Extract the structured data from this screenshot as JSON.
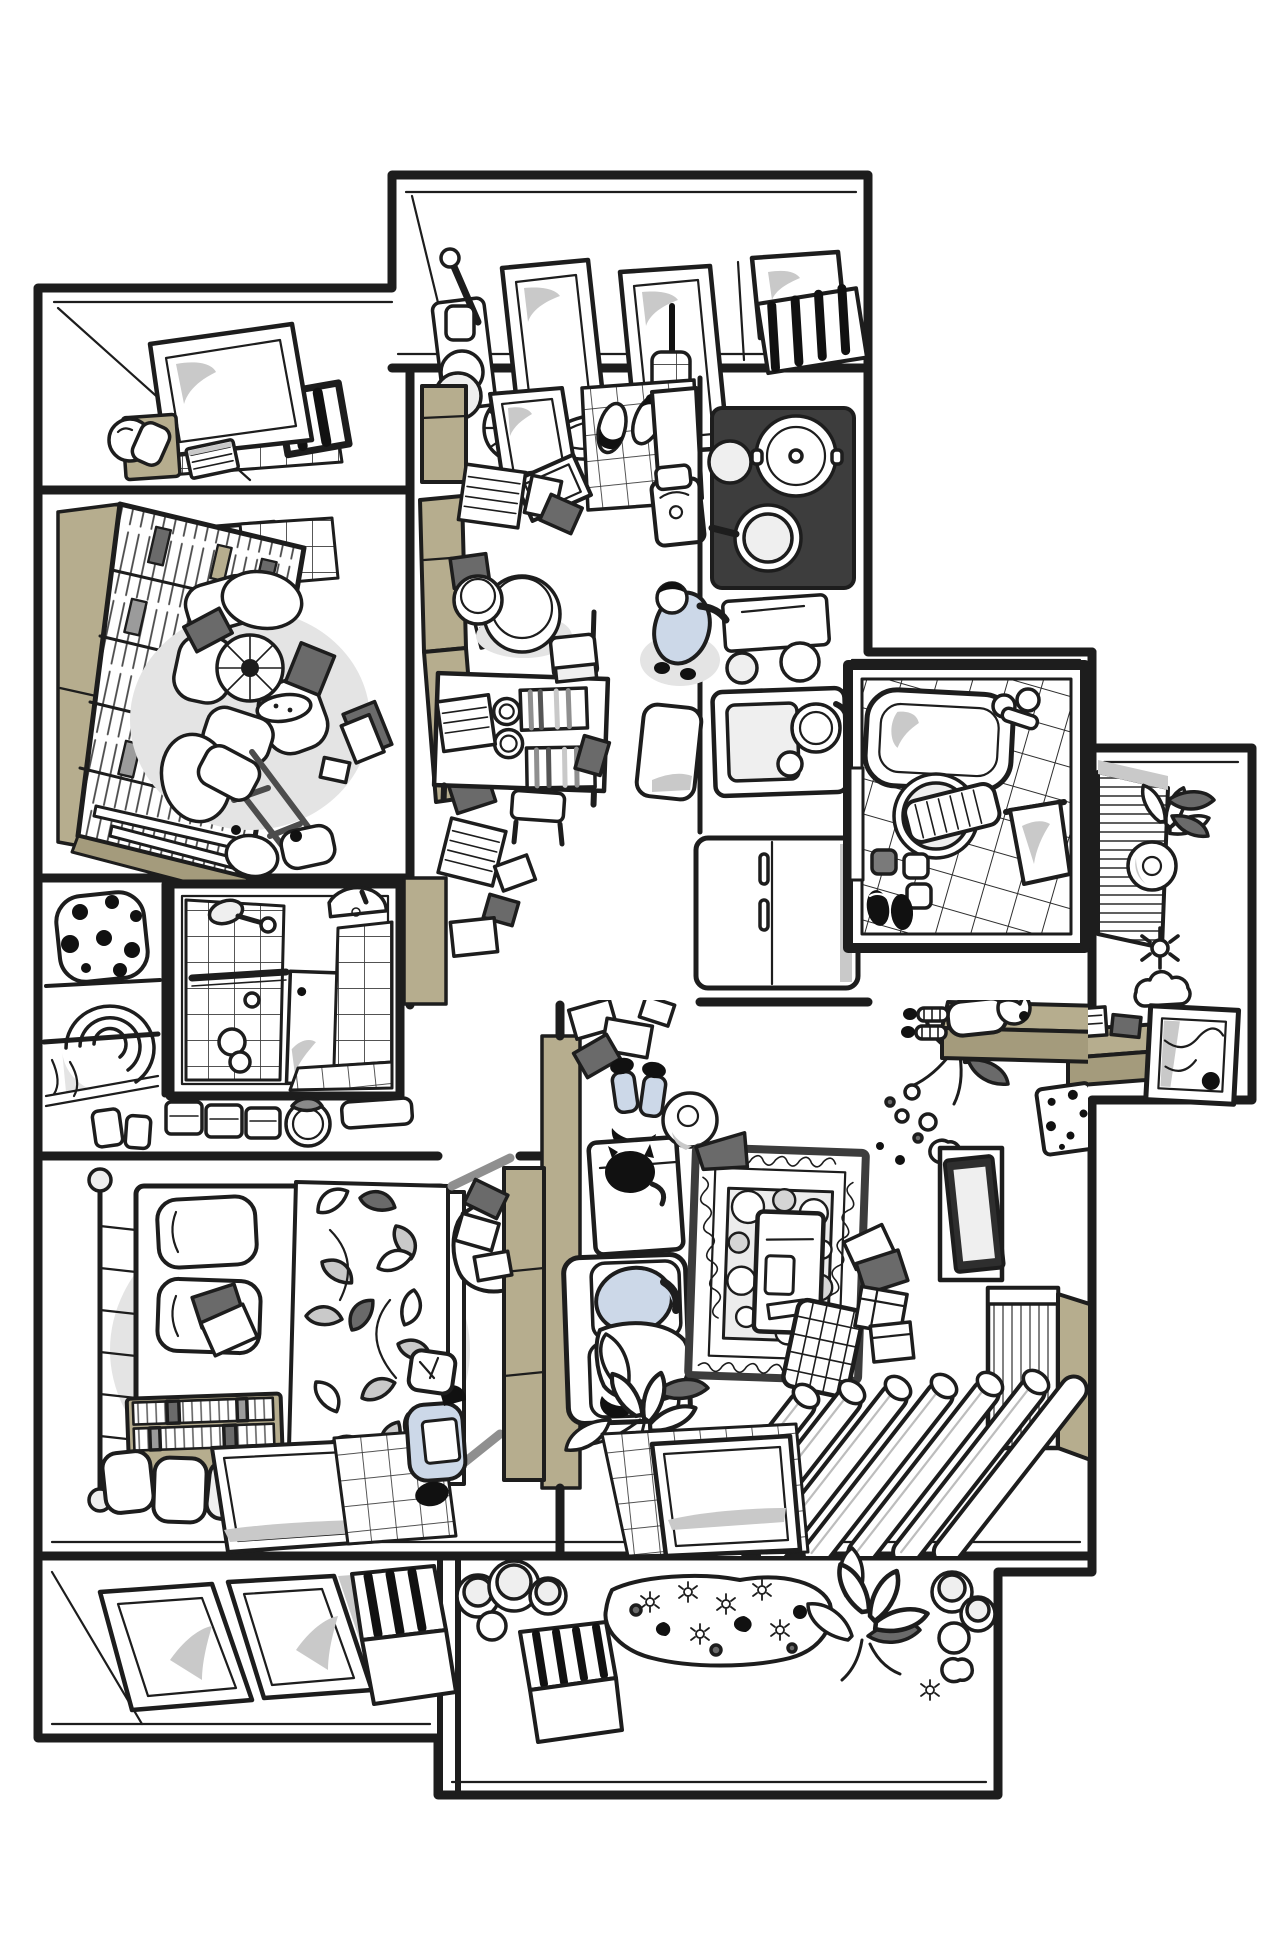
{
  "illustration": {
    "title": "Top-down cutaway illustration of a cluttered apartment floor plan",
    "medium": "hand-drawn black line art with tan, grey and pale-blue accents",
    "palette": {
      "ink": "#1d1d1d",
      "black": "#111111",
      "wall_white": "#ffffff",
      "tan": "#b6ad8e",
      "tan_dark": "#a49b7c",
      "object_dark": "#6a6a6a",
      "glass_grey": "#c9c9c9",
      "shadow_grey": "#e4e4e4",
      "clothing_blue": "#ccd8e8"
    },
    "rooms": [
      {
        "id": "utility-balcony",
        "label": "utility balcony (top)",
        "objects": [
          "mop with bucket",
          "cleaning bottles",
          "two tilted window panes",
          "electric fan",
          "wash basin",
          "hanging brush cup",
          "black drying rack",
          "slatted door mat"
        ]
      },
      {
        "id": "window-nook",
        "label": "window nook (upper left)",
        "objects": [
          "tilted window pane",
          "tan nightstand",
          "sleeping white cat",
          "striped book",
          "tiled sill",
          "dark window frame"
        ]
      },
      {
        "id": "library",
        "label": "library / study",
        "objects": [
          "tan-sided bookshelf full of books",
          "tilted window pane",
          "tiled wall patch",
          "cushion pile",
          "electric fan",
          "snack plate",
          "scattered dark books",
          "overturned chair",
          "curtain poles",
          "paper bags"
        ]
      },
      {
        "id": "closet",
        "label": "closet (left)",
        "objects": [
          "polka-dot beanbag",
          "rolled blankets",
          "hanging rod"
        ]
      },
      {
        "id": "shower-room",
        "label": "small shower room",
        "objects": [
          "tiled shower wall",
          "shower head",
          "grab bar",
          "white door with handle dot",
          "corner washbasin",
          "tiled floor",
          "small white cat"
        ]
      },
      {
        "id": "washstand",
        "label": "corridor washstand",
        "objects": [
          "pair of cups",
          "drawer boxes",
          "bucket with grey cloth",
          "white tray"
        ]
      },
      {
        "id": "bedroom",
        "label": "bedroom",
        "objects": [
          "metal rail bed frame",
          "two pillows with books",
          "leaf-pattern quilt",
          "draped pillow",
          "tan low bookshelf",
          "three white poufs",
          "white floor mat",
          "tiled mat",
          "tall tan wardrobe",
          "tumbling grey books"
        ]
      },
      {
        "id": "kitchen-dining",
        "label": "entry / kitchen / dining room",
        "objects": [
          "tan wardrobe",
          "white doors",
          "tiled entry floor",
          "two pairs of slippers",
          "leaning mirror",
          "tan bench with book stacks",
          "two round stools",
          "dining table with striped placemats and cups",
          "chairs",
          "dark stove with pots and pan",
          "counter with cutting board and bowls",
          "sink with dishes",
          "refrigerator",
          "small appliance bin",
          "floor mat",
          "scattered books"
        ]
      },
      {
        "id": "bathroom",
        "label": "bathroom with tub",
        "objects": [
          "diagonal tiled walls",
          "bathtub with towel",
          "twin faucet",
          "round basin with washboard",
          "towel on rail",
          "square mats",
          "black slippers",
          "door leaf"
        ]
      },
      {
        "id": "vanity-room",
        "label": "small vanity room (far right)",
        "objects": [
          "slatted shelf",
          "lily flowers",
          "round bowl mirror",
          "small flower",
          "cloud-shaped cushion",
          "tan desk with boxes",
          "leaning picture frame with mountain sketch"
        ]
      },
      {
        "id": "living-room",
        "label": "living room",
        "objects": [
          "scattered papers and dark book",
          "white side table",
          "round plate with cup",
          "sofa with cushions",
          "ornate rug with bubble field",
          "low white table with remote",
          "laundry grid basket",
          "stray books and boxes",
          "flower bouquet on floor",
          "tan bench",
          "TV on cabinet",
          "polka-dot boards",
          "mirror frame",
          "louvered cabinet",
          "striped drawer",
          "heart picture frames",
          "radiator tubes",
          "potted lily plant",
          "tiled floor patch with white panel"
        ]
      },
      {
        "id": "garden-balcony",
        "label": "bottom balcony / garden",
        "objects": [
          "two large window panes",
          "grey divider",
          "black drying racks",
          "round planters",
          "flower bed with stones and daisies",
          "large lily plant",
          "stacked pots",
          "white flowers"
        ]
      }
    ],
    "people": [
      {
        "id": "person-cooking",
        "pose": "standing at kitchen counter stirring a pot",
        "clothes": "pale blue"
      },
      {
        "id": "person-reading",
        "pose": "sitting on tiled mat in bedroom reading a book",
        "clothes": "pale blue overalls, white head wrap"
      },
      {
        "id": "person-sofa",
        "pose": "lying on living room sofa under white blanket",
        "clothes": "pale blue"
      },
      {
        "id": "person-floor",
        "pose": "lying on floor by side table, jeans legs outstretched",
        "clothes": "pale blue jeans"
      },
      {
        "id": "person-bench",
        "pose": "lying on tan bench near bathroom",
        "clothes": "white top, striped leggings"
      }
    ],
    "pets": [
      {
        "id": "cat-nook",
        "look": "white cat curled on nightstand"
      },
      {
        "id": "cat-table",
        "look": "black cat sitting on side table"
      },
      {
        "id": "cat-shower",
        "look": "small white cat in shower room"
      }
    ]
  }
}
